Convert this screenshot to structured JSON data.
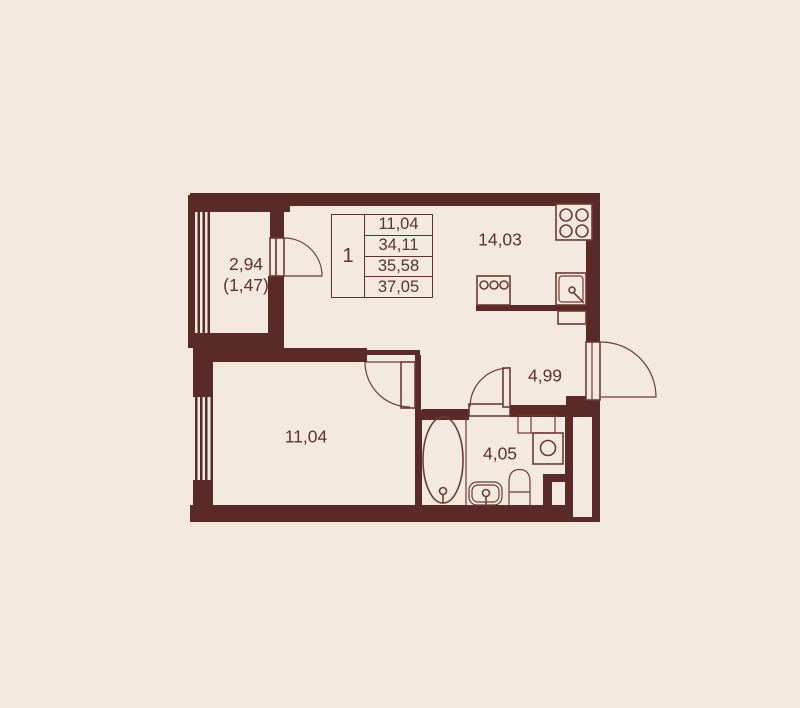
{
  "plan": {
    "colors": {
      "bg": "#f3e9df",
      "wall": "#5a2a28",
      "line": "#6f3a36",
      "text": "#5f3131"
    },
    "info_table": {
      "rooms_count": "1",
      "rows": [
        "11,04",
        "34,11",
        "35,58",
        "37,05"
      ]
    },
    "rooms": {
      "balcony": {
        "area": "2,94",
        "area_secondary": "(1,47)"
      },
      "kitchen_living": {
        "area": "14,03"
      },
      "hallway": {
        "area": "4,99"
      },
      "living_room": {
        "area": "11,04"
      },
      "bathroom": {
        "area": "4,05"
      }
    }
  }
}
